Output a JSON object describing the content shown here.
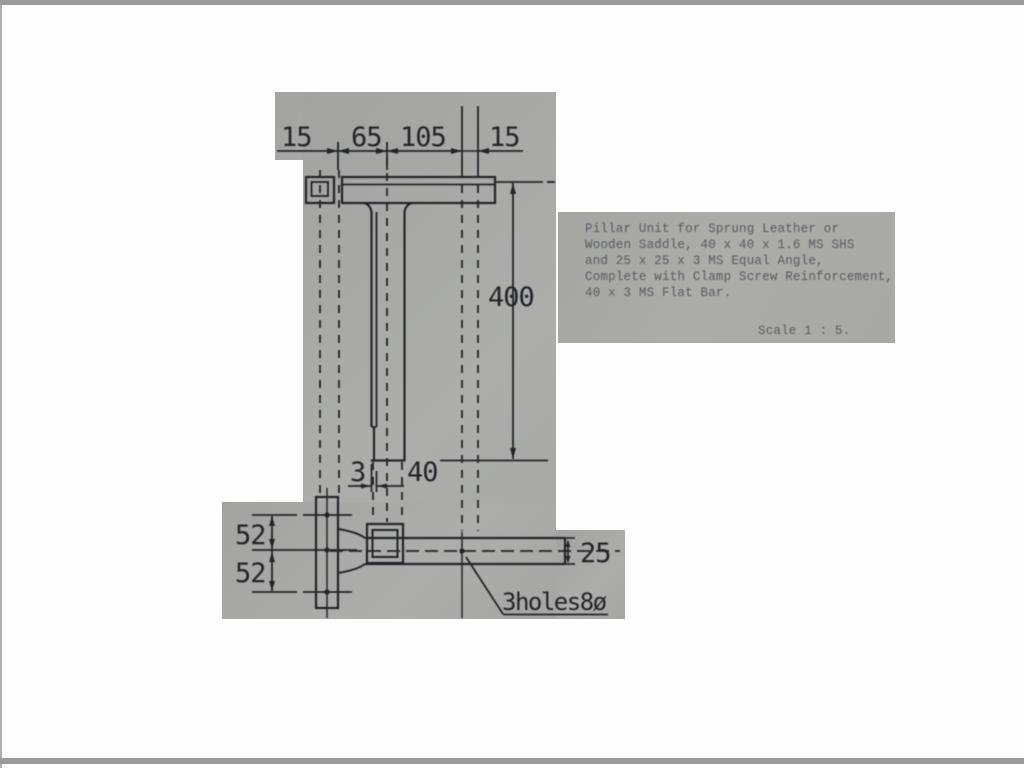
{
  "colors": {
    "page_bg": "#fdfdfd",
    "edge_band": "#9a9a9a",
    "paper_gray": "#a9aaa8",
    "ink": "#232428",
    "typed_ink": "#575c63"
  },
  "title_block": {
    "lines": [
      "Pillar Unit for Sprung Leather or",
      "Wooden Saddle, 40 x 40 x 1.6 MS SHS",
      "and 25 x 25 x 3 MS Equal Angle,",
      "Complete with Clamp Screw Reinforcement,",
      "40 x 3 MS Flat Bar."
    ],
    "scale_note": "Scale 1 : 5."
  },
  "dimensions": {
    "top": [
      "15",
      "65",
      "105",
      "15"
    ],
    "pillar_height": "400",
    "wall_thickness": "3",
    "pillar_width": "40",
    "hole_pitch_upper": "52",
    "hole_pitch_lower": "52",
    "flat_bar_width": "25",
    "holes_note": "3holes8ø"
  }
}
